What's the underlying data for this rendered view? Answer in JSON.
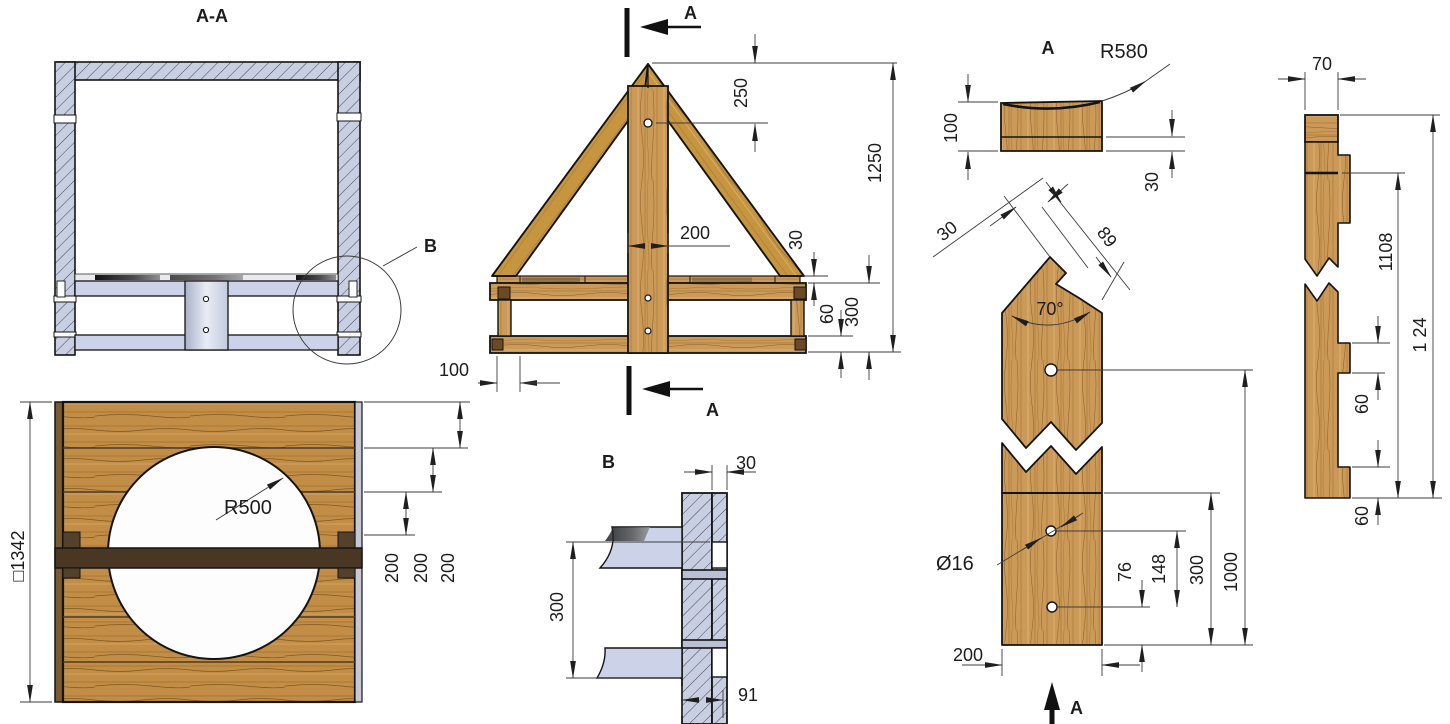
{
  "drawing_type": "technical-woodworking-drawing",
  "colors": {
    "wood": "#cb9a58",
    "wood_panel": "#c28e47",
    "wood_dark_bar": "#4a3723",
    "hatch_fill": "#c9cfe2",
    "plate_fill": "#ccd3e8",
    "line": "#1c1c1c"
  },
  "views": {
    "section_aa": {
      "title": "A-A",
      "detail_ref": "B"
    },
    "truss": {
      "marker_top": "A",
      "marker_bottom": "A",
      "d250": "250",
      "d1250": "1250",
      "d200": "200",
      "d30": "30",
      "d60": "60",
      "d300": "300",
      "d100": "100"
    },
    "cap": {
      "label": "A",
      "r580": "R580",
      "d100": "100",
      "d30": "30"
    },
    "post": {
      "angle": "70°",
      "d30": "30",
      "d89": "89",
      "dia16": "Ø16",
      "d76": "76",
      "d148": "148",
      "d300": "300",
      "d1000": "1000",
      "d200": "200",
      "marker": "A"
    },
    "plank": {
      "d70": "70",
      "d1108": "1108",
      "d1124": "1 24",
      "d60_upper": "60",
      "d60_lower": "60"
    },
    "panel": {
      "r500": "R500",
      "side": "□1342",
      "d200_1": "200",
      "d200_2": "200",
      "d200_3": "200"
    },
    "detail_b": {
      "label": "B",
      "d30": "30",
      "d300": "300",
      "d91": "91"
    }
  }
}
